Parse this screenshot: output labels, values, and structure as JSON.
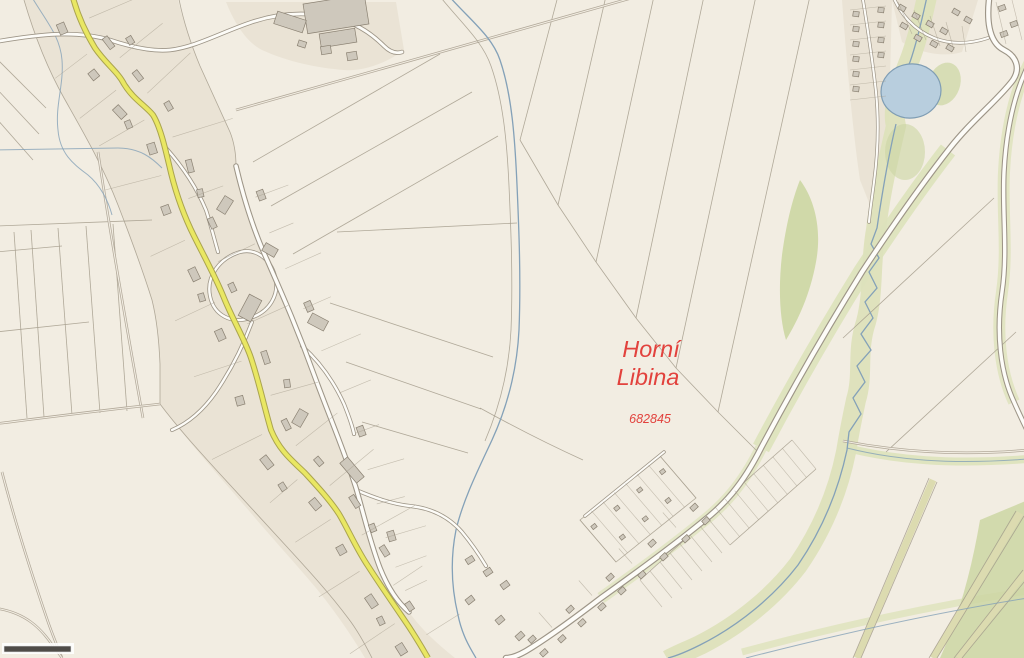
{
  "map": {
    "place_label": {
      "line1": "Horní",
      "line2": "Libina"
    },
    "cadastral_code": "682845",
    "palette": {
      "background": "#f2ede2",
      "village_area": "#eae3d5",
      "parcel_line": "#a59c8c",
      "building_fill": "#cec8bc",
      "building_stroke": "#8a8172",
      "road_fill": "#fdfcf8",
      "road_casing": "#9d9587",
      "main_road_yellow": "#e9e763",
      "yellow_casing": "#aaa44f",
      "track": "#b2a99a",
      "stream": "#84a1b8",
      "pond_fill": "#b8cede",
      "pond_stroke": "#7f9db4",
      "green_light": "#dde2bb",
      "green_mid": "#ccd6a3",
      "green_strip": "#dcdbb0",
      "label_red": "#e2423d",
      "scale_bar": "#4f4c48"
    }
  }
}
